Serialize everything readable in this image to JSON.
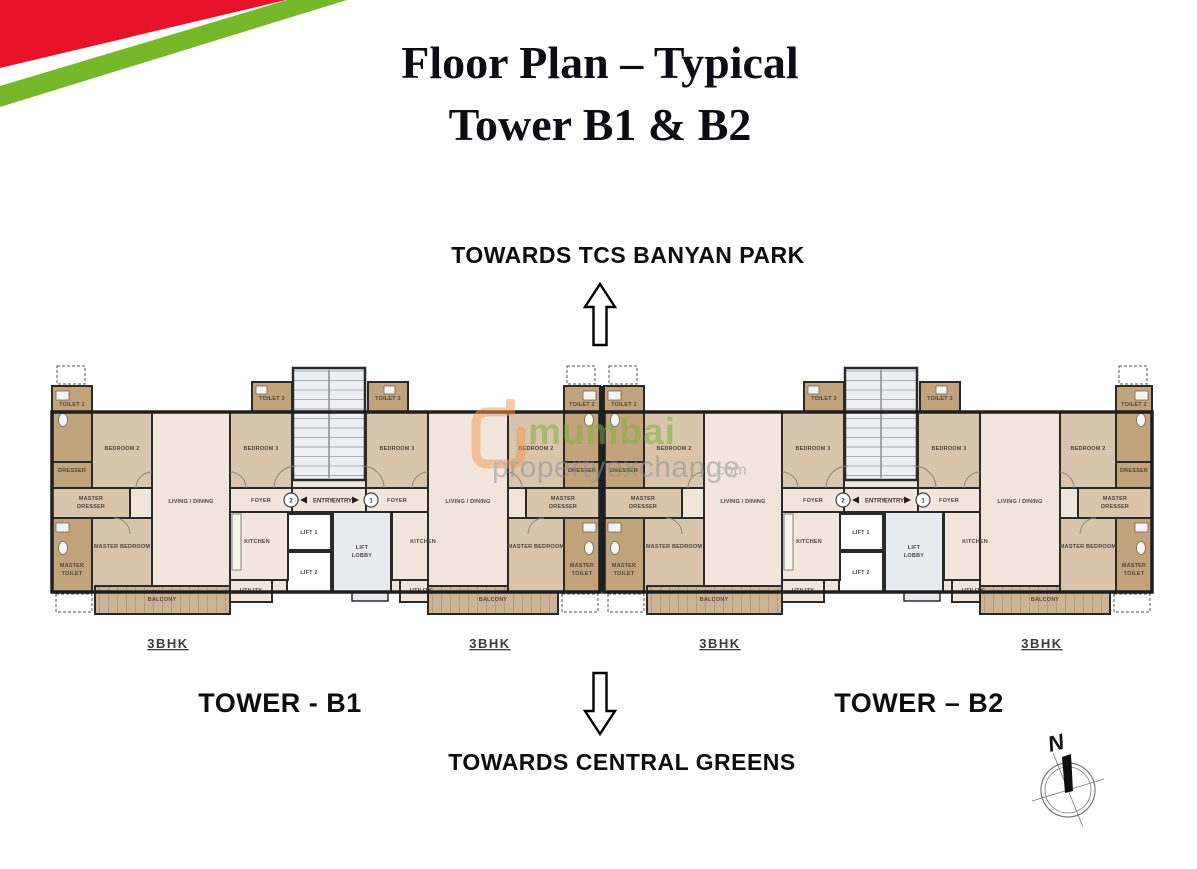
{
  "title": {
    "line1": "Floor Plan – Typical",
    "line2": "Tower B1 & B2"
  },
  "orientation": {
    "top_label": "TOWARDS TCS BANYAN PARK",
    "bottom_label": "TOWARDS CENTRAL GREENS",
    "compass_north": "N"
  },
  "towers": {
    "b1_label": "TOWER - B1",
    "b2_label": "TOWER – B2",
    "unit_type_label": "3BHK"
  },
  "rooms": {
    "bedroom2": "BEDROOM 2",
    "bedroom3": "BEDROOM 3",
    "toilet2": "TOILET 2",
    "toilet3": "TOILET 3",
    "dresser": "DRESSER",
    "master": "MASTER",
    "toilet": "TOILET",
    "master_bedroom": "MASTER BEDROOM",
    "living_dining": "LIVING / DINING",
    "kitchen": "KITCHEN",
    "utility": "UTILITY",
    "balcony": "BALCONY",
    "foyer": "FOYER"
  },
  "core": {
    "lift1": "LIFT 1",
    "lift2": "LIFT 2",
    "lift_line1": "LIFT",
    "lobby_line2": "LOBBY",
    "entry_label": "ENTRY",
    "entry_point_1": "1",
    "entry_point_2": "2"
  },
  "watermark": {
    "brand_primary": "mumbai",
    "brand_secondary": "propertyexchange",
    "domain_suffix": ".com"
  },
  "colors": {
    "ribbon_red": "#e8132b",
    "ribbon_green": "#76b82a",
    "watermark_orange": "#f29a56",
    "watermark_green": "#7cae3e",
    "room_tan": "#d8c5ab",
    "room_dark_tan": "#c2a47c",
    "room_light": "#f2e6dc",
    "core_gray": "#e7eaef",
    "wall_dark": "#1f1f1f"
  }
}
